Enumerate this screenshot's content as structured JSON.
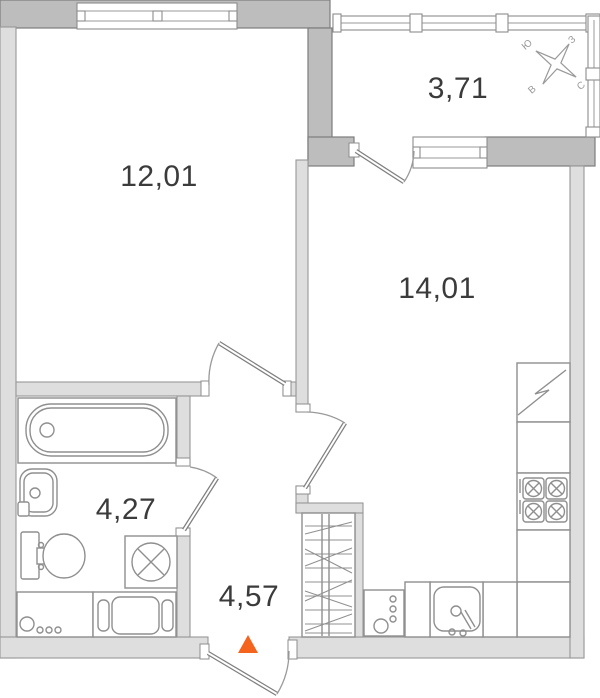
{
  "rooms": {
    "living": {
      "area": "12,01"
    },
    "kitchen": {
      "area": "14,01"
    },
    "balcony": {
      "area": "3,71"
    },
    "bathroom": {
      "area": "4,27"
    },
    "hallway": {
      "area": "4,57"
    }
  },
  "compass": {
    "north": "С",
    "south": "Ю",
    "east": "В",
    "west": "З"
  },
  "colors": {
    "entrance_marker": "#f4641d",
    "wall_dark": "#bdbdbd",
    "wall_light": "#dedede",
    "fixture_line": "#8f8f8f",
    "label_text": "#3b3b3b"
  }
}
